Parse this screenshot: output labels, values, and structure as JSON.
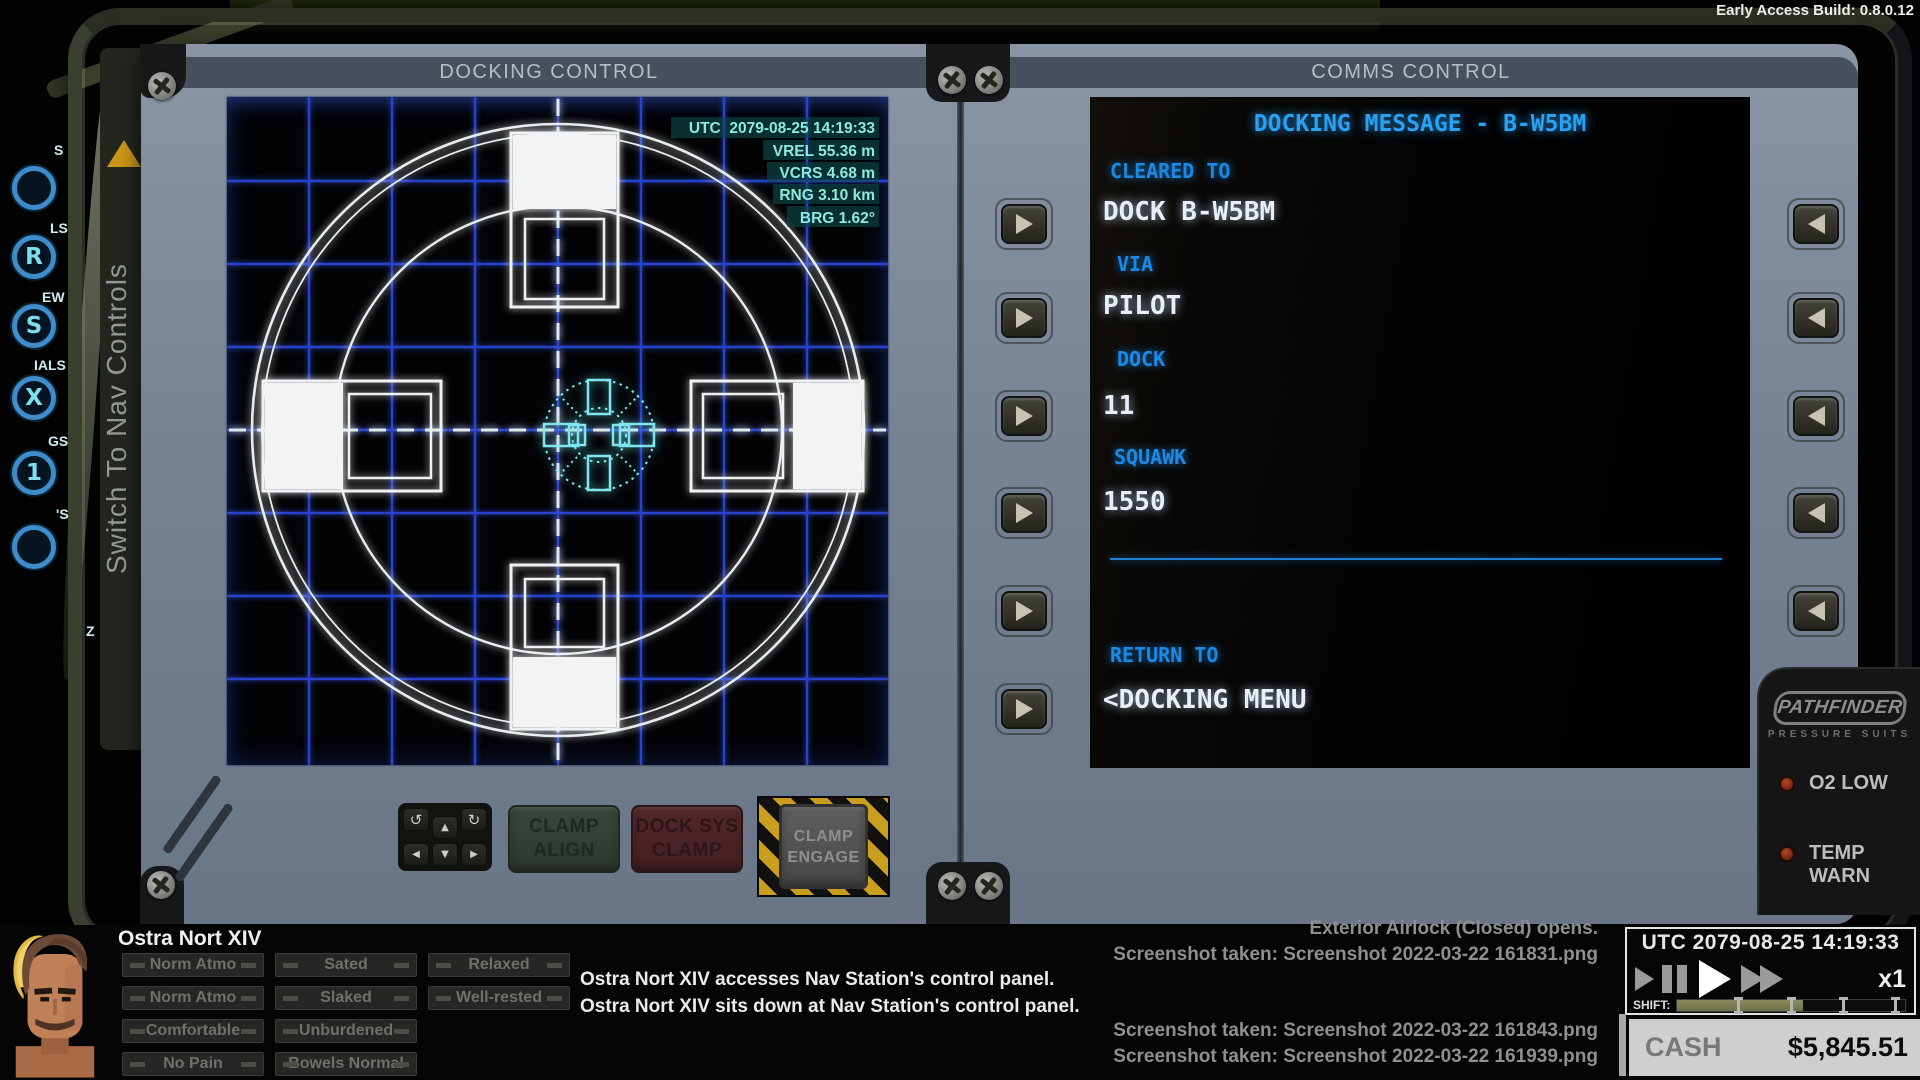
{
  "build_label": "Early Access Build: 0.8.0.12",
  "colors": {
    "console": "#7b8799",
    "radar_grid": "#2946d6",
    "radar_white": "#e6edf0",
    "radar_cyan": "#7fe6f0",
    "hud_teal": "#8ceade",
    "comms_blue": "#1b8ae4",
    "comms_value_white": "#e9eef8",
    "hazard_yellow": "#c99e1e",
    "alert_led_red": "#7a2410",
    "nav_triangle_orange": "#cf9718",
    "shift_fill_olive": "#7c8054"
  },
  "icons": {
    "rotate_ccw": "↺",
    "rotate_cw": "↻",
    "pad_up": "▲",
    "pad_down": "▼",
    "pad_left": "◀",
    "pad_right": "▶",
    "side_next": "▶",
    "side_prev": "◀",
    "play": "▶",
    "pause": "⏸",
    "fast_forward": "⏩",
    "screw": "✜"
  },
  "sidebar": {
    "labels": [
      "S",
      "LS",
      "EW",
      "IALS",
      "GS",
      "'S",
      "Z"
    ],
    "glyphs": [
      "",
      "R",
      "S",
      "X",
      "1",
      ""
    ]
  },
  "nav_switch": {
    "label": "Switch To Nav Controls"
  },
  "docking": {
    "title": "DOCKING CONTROL",
    "hud": {
      "utc": "UTC  2079-08-25 14:19:33",
      "vrel": "VREL 55.36 m",
      "vcrs": "VCRS 4.68 m",
      "rng": "RNG 3.10 km",
      "brg": "BRG 1.62°"
    },
    "buttons": {
      "clamp_align": "CLAMP\nALIGN",
      "dock_sys_clamp": "DOCK SYS\nCLAMP",
      "clamp_engage": "CLAMP\nENGAGE"
    }
  },
  "comms": {
    "title": "COMMS CONTROL",
    "message_title": "DOCKING MESSAGE - B-W5BM",
    "fields": [
      {
        "label": "CLEARED TO",
        "value": "DOCK B-W5BM"
      },
      {
        "label": "VIA",
        "value": "PILOT"
      },
      {
        "label": "DOCK",
        "value": "11"
      },
      {
        "label": "SQUAWK",
        "value": "1550"
      }
    ],
    "return_field": {
      "label": "RETURN TO",
      "value": "<DOCKING MENU"
    }
  },
  "pathfinder": {
    "brand": "PATHFINDER",
    "sub_brand": "PRESSURE SUITS",
    "warnings": [
      "O2 LOW",
      "TEMP WARN"
    ]
  },
  "status_bar": {
    "character": {
      "name": "Ostra Nort XIV",
      "conditions": [
        [
          "Norm Atmo",
          "Sated",
          "Relaxed"
        ],
        [
          "Norm Atmo",
          "Slaked",
          "Well-rested"
        ],
        [
          "Comfortable",
          "Unburdened"
        ],
        [
          "No Pain",
          "Bowels Normal"
        ]
      ]
    },
    "log_white": [
      "Ostra Nort XIV accesses Nav Station's control panel.",
      "Ostra Nort XIV sits down at Nav Station's control panel."
    ],
    "log_gray_top": [
      "Exterior Airlock (Closed) opens.",
      "Screenshot taken: Screenshot 2022-03-22 161831.png"
    ],
    "log_gray_bottom": [
      "Screenshot taken: Screenshot 2022-03-22 161843.png",
      "Screenshot taken: Screenshot 2022-03-22 161939.png"
    ],
    "clock": {
      "utc": "UTC 2079-08-25 14:19:33",
      "speed": "x1",
      "shift_label": "SHIFT:"
    },
    "cash": {
      "label": "CASH",
      "value": "$5,845.51"
    }
  }
}
